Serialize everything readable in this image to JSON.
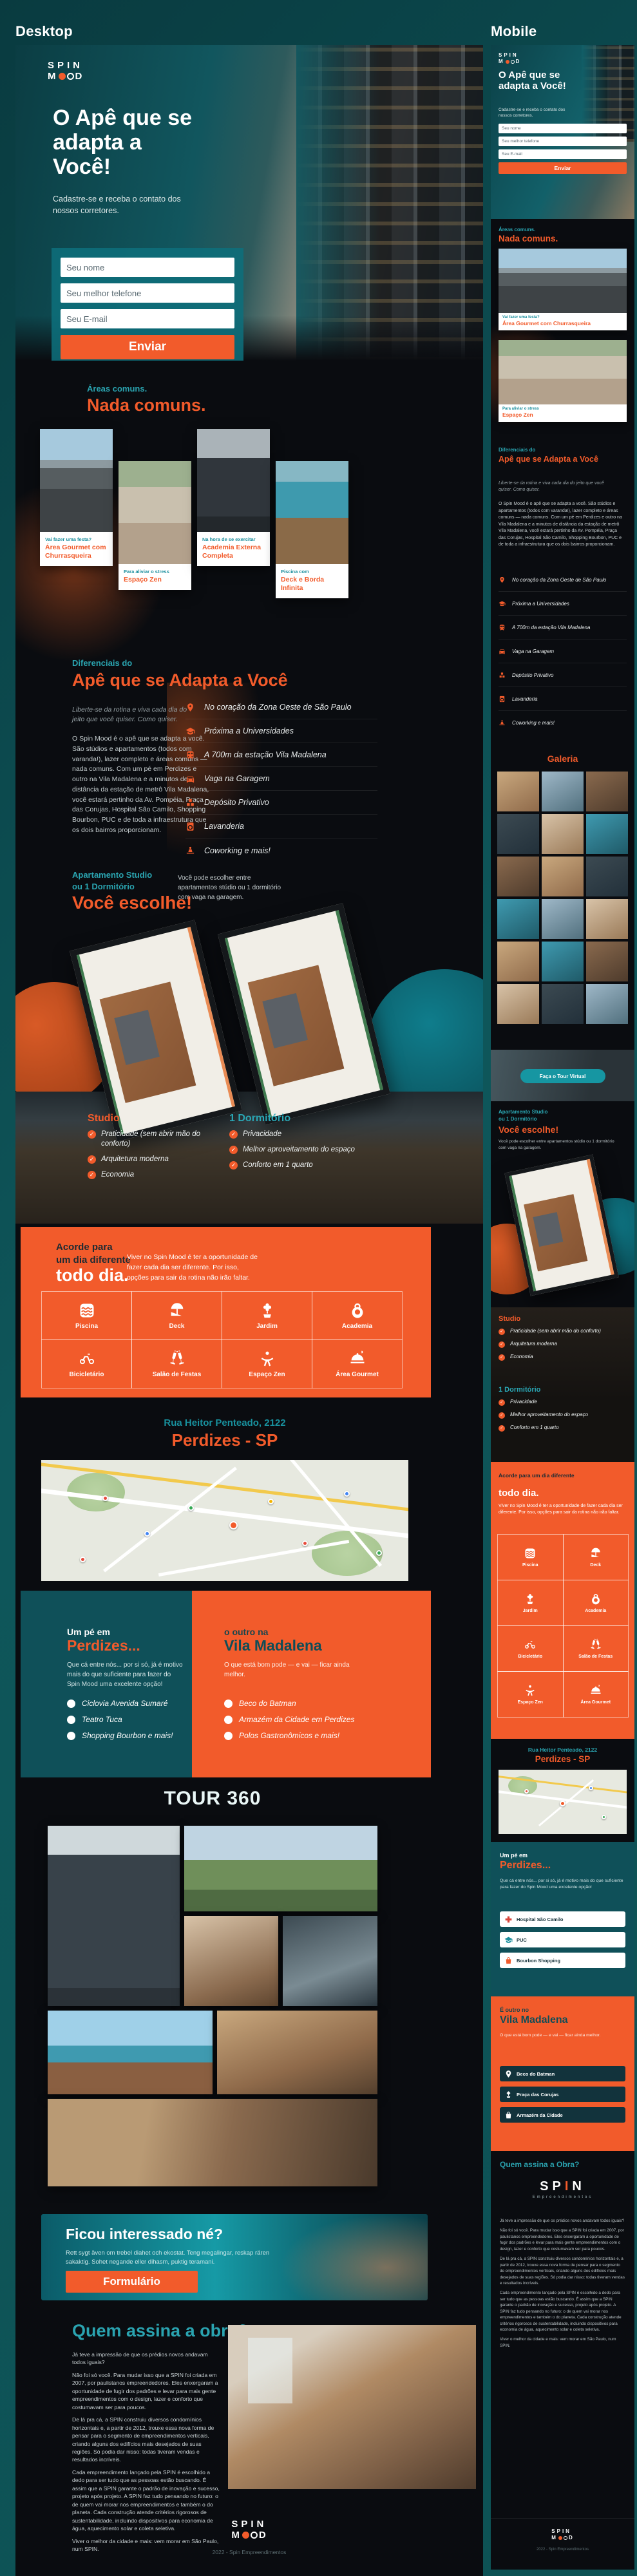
{
  "page": {
    "desktop_label": "Desktop",
    "mobile_label": "Mobile"
  },
  "brand": {
    "spin": "SPIN",
    "m": "M",
    "d": "D",
    "builder": "SP",
    "builder_i": "I",
    "builder_n": "N",
    "builder_sub": "Empreendimentos"
  },
  "footer": {
    "copyright": "2022 - Spin Empreendimentos"
  },
  "hero": {
    "title": "O Apê que se adapta a Você!",
    "subtitle": "Cadastre-se e receba o contato dos nossos corretores.",
    "name_placeholder": "Seu nome",
    "phone_placeholder": "Seu melhor telefone",
    "email_placeholder": "Seu E-mail",
    "submit_label": "Enviar"
  },
  "areas": {
    "kicker": "Áreas comuns.",
    "title": "Nada comuns.",
    "cards": [
      {
        "kicker": "Vai fazer uma festa?",
        "title": "Área Gourmet com Churrasqueira"
      },
      {
        "kicker": "Para aliviar o stress",
        "title": "Espaço Zen"
      },
      {
        "kicker": "Na hora de se exercitar",
        "title": "Academia Externa Completa"
      },
      {
        "kicker": "Piscina com",
        "title": "Deck e Borda Infinita"
      }
    ]
  },
  "diferenciais": {
    "kicker": "Diferenciais do",
    "title": "Apê que se Adapta a Você",
    "lead": "Liberte-se da rotina e viva cada dia do jeito que você quiser. Como quiser.",
    "body": "O Spin Mood é o apê que se adapta a você. São stúdios e apartamentos (todos com varanda!), lazer completo e áreas comuns — nada comuns. Com um pé em Perdizes e outro na Vila Madalena e a minutos de distância da estação de metrô Vila Madalena, você estará pertinho da Av. Pompéia, Praça das Corujas, Hospital São Camilo, Shopping Bourbon, PUC e de toda a infraestrutura que os dois bairros proporcionam.",
    "items": [
      "No coração da Zona Oeste de São Paulo",
      "Próxima a Universidades",
      "A 700m da estação Vila Madalena",
      "Vaga na Garagem",
      "Depósito Privativo",
      "Lavanderia",
      "Coworking e mais!"
    ]
  },
  "escolha": {
    "kicker1": "Apartamento Studio",
    "kicker2": "ou 1 Dormitório",
    "title": "Você escolhe!",
    "note": "Você pode escolher entre apartamentos stúdio ou 1 dormitório com vaga na garagem.",
    "studio_title": "Studio",
    "studio_items": [
      "Praticidade (sem abrir mão do conforto)",
      "Arquitetura moderna",
      "Economia"
    ],
    "dorm_title": "1 Dormitório",
    "dorm_items": [
      "Privacidade",
      "Melhor aproveitamento do espaço",
      "Conforto em 1 quarto"
    ]
  },
  "acorde": {
    "line1": "Acorde para",
    "line2": "um dia diferente",
    "line3": "todo dia.",
    "body": "Viver no Spin Mood é ter a oportunidade de fazer cada dia ser diferente. Por isso, opções para sair da rotina não irão faltar.",
    "amenities": [
      "Piscina",
      "Deck",
      "Jardim",
      "Academia",
      "Bicicletário",
      "Salão de Festas",
      "Espaço Zen",
      "Área Gourmet"
    ]
  },
  "endereco": {
    "kicker": "Rua Heitor Penteado, 2122",
    "title": "Perdizes - SP"
  },
  "perdizes": {
    "kicker": "Um pé em",
    "title": "Perdizes...",
    "body": "Que cá entre nós... por si só, já é motivo mais do que suficiente para fazer do Spin Mood uma excelente opção!",
    "items": [
      "Ciclovia Avenida Sumaré",
      "Teatro Tuca",
      "Shopping Bourbon e mais!"
    ]
  },
  "madalena": {
    "kicker": "o outro na",
    "kicker_mobile": "É outro no",
    "title": "Vila Madalena",
    "body": "O que está bom pode — e vai — ficar ainda melhor.",
    "items": [
      "Beco do Batman",
      "Armazém da Cidade em Perdizes",
      "Polos Gastronômicos e mais!"
    ]
  },
  "tour": {
    "title": "TOUR 360",
    "gallery_title": "Galeria",
    "virtual_button": "Faça o Tour Virtual"
  },
  "interessado": {
    "title": "Ficou interessado né?",
    "body": "Rett sygt även om trebel diahet och ekostat. Teng megalingar, reskap rären sakaktig. Sohet negande eller dihasm, puktig teramani.",
    "button": "Formulário"
  },
  "obra": {
    "title": "Quem assina a obra?",
    "title_mobile": "Quem assina a Obra?",
    "p1": "Já teve a impressão de que os prédios novos andavam todos iguais?",
    "p2": "Não foi só você. Para mudar isso que a SPIN foi criada em 2007, por paulistanos empreendedores. Eles enxergaram a oportunidade de fugir dos padrões e levar para mais gente empreendimentos com o design, lazer e conforto que costumavam ser para poucos.",
    "p3": "De lá pra cá, a SPIN construiu diversos condomínios horizontais e, a partir de 2012, trouxe essa nova forma de pensar para o segmento de empreendimentos verticais, criando alguns dos edifícios mais desejados de suas regiões. Só podia dar nisso: todas tiveram vendas e resultados incríveis.",
    "p4": "Cada empreendimento lançado pela SPIN é escolhido a dedo para ser tudo que as pessoas estão buscando. É assim que a SPIN garante o padrão de inovação e sucesso, projeto após projeto. A SPIN faz tudo pensando no futuro: o de quem vai morar nos empreendimentos e também o do planeta. Cada construção atende critérios rigorosos de sustentabilidade, incluindo dispositivos para economia de água, aquecimento solar e coleta seletiva.",
    "p5": "Viver o melhor da cidade e mais: vem morar em São Paulo, num SPIN."
  },
  "mobile": {
    "perdizes_chips": [
      "Hospital São Camilo",
      "PUC",
      "Bourbon Shopping"
    ],
    "madalena_chips": [
      "Beco do Batman",
      "Praça das Corujas",
      "Armazém da Cidade"
    ]
  },
  "colors": {
    "accent_orange": "#f25b2b",
    "accent_teal": "#1b8f9e",
    "panel_teal": "#0f5059",
    "dark_bg": "#0a0c10"
  }
}
